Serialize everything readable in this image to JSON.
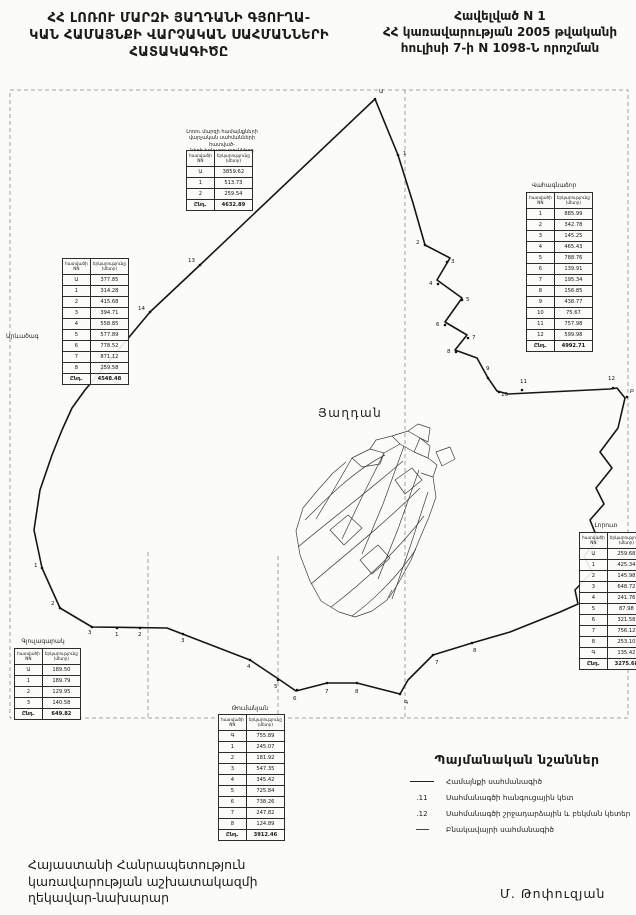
{
  "header": {
    "title_lines": [
      "ՀՀ ԼՈՌՈՒ ՄԱՐԶԻ ՅԱՂԴԱՆԻ  ԳՅՈՒՂԱ-",
      "ԿԱՆ ՀԱՄԱՅՆՔԻ ՎԱՐՉԱԿԱՆ ՍԱՀՄԱՆՆԵՐԻ",
      "ՀԱՏԱԿԱԳԻԾԸ"
    ],
    "annex_lines": [
      "Հավելված N 1",
      "ՀՀ կառավարության 2005 թվականի",
      "հուլիսի 7-ի  N 1098-Ն որոշման"
    ]
  },
  "map": {
    "community_label": "Յաղդան",
    "neighbor_label_left": "Արևածագ",
    "boundary_points": "375,99 398,155 413,203 425,245 450,258 437,280 462,298 445,322 467,335 455,350 477,358 488,378 497,391 508,394 610,389 617,388 625,398 618,428 600,452 612,468 596,488 604,504 590,520 598,540 584,556 592,572 575,590 578,604 560,612 510,632 472,643 433,655 408,680 400,694 357,683 327,683 296,691 280,680 250,660 167,628 92,627 60,608 42,568 34,530 40,490 52,455 62,430 72,408 85,390 150,312 200,265 375,99",
    "parcel_paths": [
      "M352,458 L370,449 L384,453 L380,464 L362,467 Z",
      "M370,449 L376,440 L392,436 L400,444 L384,453",
      "M392,436 L408,431 L420,438 L414,452 L400,444",
      "M408,431 L418,424 L430,428 L428,442 L420,438",
      "M420,438 L430,446 L428,458 L414,452",
      "M428,458 L437,465 L433,477 L421,473",
      "M346,462 L333,473 L317,491 L303,508",
      "M303,508 L296,531 L300,555 L310,581",
      "M310,581 L321,601 L339,612 L355,617",
      "M355,617 L372,611 L387,600 L392,590",
      "M433,477 L436,497 L429,517 L420,538 L411,560 L399,582 L389,598",
      "M305,520 C330,495 355,470 385,455",
      "M298,547 C330,520 365,494 403,461",
      "M311,584 C346,554 384,524 420,488",
      "M331,607 C361,584 395,554 424,516",
      "M352,616 C375,599 399,575 416,549",
      "M352,458 L333,491 L316,519",
      "M384,453 L361,499 L342,539",
      "M404,446 L383,504 L362,554",
      "M419,470 L398,529 L378,579",
      "M428,492 L410,547 L392,599",
      "M330,530 L348,515 L362,528 L344,545 Z",
      "M360,560 L378,545 L390,558 L372,574 Z",
      "M395,480 L412,468 L422,480 L405,494 Z",
      "M436,452 L450,447 L455,459 L442,466 Z"
    ],
    "points": [
      {
        "t": "Ա",
        "x": 375,
        "y": 99,
        "dx": 4,
        "dy": -6
      },
      {
        "t": "1",
        "x": 398,
        "y": 155,
        "dx": 5,
        "dy": 0
      },
      {
        "t": "2",
        "x": 425,
        "y": 245,
        "dx": -9,
        "dy": -1
      },
      {
        "t": "3",
        "x": 447,
        "y": 262,
        "dx": 4,
        "dy": 1
      },
      {
        "t": "4",
        "x": 438,
        "y": 284,
        "dx": -9,
        "dy": 1
      },
      {
        "t": "5",
        "x": 462,
        "y": 300,
        "dx": 4,
        "dy": 1
      },
      {
        "t": "6",
        "x": 445,
        "y": 325,
        "dx": -9,
        "dy": 1
      },
      {
        "t": "7",
        "x": 468,
        "y": 338,
        "dx": 4,
        "dy": 1
      },
      {
        "t": "8",
        "x": 456,
        "y": 352,
        "dx": -9,
        "dy": 1
      },
      {
        "t": "9",
        "x": 488,
        "y": 378,
        "dx": -2,
        "dy": -8
      },
      {
        "t": "10",
        "x": 499,
        "y": 392,
        "dx": 2,
        "dy": 4
      },
      {
        "t": "11",
        "x": 522,
        "y": 390,
        "dx": -2,
        "dy": -7
      },
      {
        "t": "12",
        "x": 613,
        "y": 388,
        "dx": -5,
        "dy": -8
      },
      {
        "t": "Բ",
        "x": 627,
        "y": 397,
        "dx": 3,
        "dy": -4
      },
      {
        "t": "13",
        "x": 200,
        "y": 265,
        "dx": -12,
        "dy": -3
      },
      {
        "t": "14",
        "x": 150,
        "y": 312,
        "dx": -12,
        "dy": -2
      },
      {
        "t": "1",
        "x": 42,
        "y": 568,
        "dx": -8,
        "dy": -1
      },
      {
        "t": "2",
        "x": 60,
        "y": 608,
        "dx": -9,
        "dy": -3
      },
      {
        "t": "3",
        "x": 92,
        "y": 627,
        "dx": -4,
        "dy": 7
      },
      {
        "t": "1",
        "x": 117,
        "y": 628,
        "dx": -2,
        "dy": 8
      },
      {
        "t": "2",
        "x": 140,
        "y": 628,
        "dx": -2,
        "dy": 8
      },
      {
        "t": "3",
        "x": 183,
        "y": 634,
        "dx": -2,
        "dy": 8
      },
      {
        "t": "4",
        "x": 250,
        "y": 660,
        "dx": -3,
        "dy": 8
      },
      {
        "t": "5",
        "x": 278,
        "y": 680,
        "dx": -4,
        "dy": 8
      },
      {
        "t": "6",
        "x": 297,
        "y": 690,
        "dx": -4,
        "dy": 10
      },
      {
        "t": "7",
        "x": 327,
        "y": 683,
        "dx": -2,
        "dy": 10
      },
      {
        "t": "8",
        "x": 357,
        "y": 683,
        "dx": -2,
        "dy": 10
      },
      {
        "t": "Գ",
        "x": 400,
        "y": 694,
        "dx": 4,
        "dy": 10
      },
      {
        "t": "7",
        "x": 433,
        "y": 655,
        "dx": 2,
        "dy": 9
      },
      {
        "t": "8",
        "x": 472,
        "y": 643,
        "dx": 1,
        "dy": 9
      }
    ]
  },
  "tables_common": {
    "col_point": "հատվածի NN",
    "col_length": "երկարությունը (մետր)",
    "total_label": "Ընդ."
  },
  "tables": {
    "north": {
      "caption_lines": [
        "Լոռու մարզի համայնքների",
        "վարչական սահմանների հատված-",
        "ների երկարությունները"
      ],
      "points": [
        "Ա",
        "1",
        "2"
      ],
      "lengths": [
        "3859.62",
        "513.73",
        "259.54"
      ],
      "total": "4632.89"
    },
    "west": {
      "points": [
        "Ա",
        "1",
        "2",
        "3",
        "4",
        "5",
        "6",
        "7",
        "8"
      ],
      "lengths": [
        "377.85",
        "314.28",
        "415.68",
        "394.71",
        "558.85",
        "577.89",
        "778.52",
        "871.12",
        "259.58"
      ],
      "total": "4548.48"
    },
    "east_upper": {
      "caption": "Վահագնաձոր",
      "points": [
        "1",
        "2",
        "3",
        "4",
        "5",
        "6",
        "7",
        "8",
        "9",
        "10",
        "11",
        "12"
      ],
      "lengths": [
        "885.99",
        "342.78",
        "145.25",
        "465.43",
        "788.76",
        "139.91",
        "195.34",
        "156.85",
        "438.77",
        "75.67",
        "757.98",
        "599.98"
      ],
      "total": "4992.71"
    },
    "east_lower": {
      "caption": "Լորուտ",
      "points": [
        "Ա",
        "1",
        "2",
        "3",
        "4",
        "5",
        "6",
        "7",
        "8",
        "Գ"
      ],
      "lengths": [
        "259.68",
        "425.34",
        "145.98",
        "648.72",
        "241.76",
        "87.98",
        "321.58",
        "756.12",
        "253.10",
        "135.42"
      ],
      "total": "3275.68"
    },
    "south_west": {
      "caption": "Գյուլագարակ",
      "points": [
        "Ա",
        "1",
        "2",
        "3"
      ],
      "lengths": [
        "189.50",
        "189.79",
        "129.95",
        "140.58"
      ],
      "total": "649.82"
    },
    "south": {
      "caption": "Թումանյան",
      "points": [
        "Գ",
        "1",
        "2",
        "3",
        "4",
        "5",
        "6",
        "7",
        "8"
      ],
      "lengths": [
        "755.89",
        "245.07",
        "181.92",
        "547.35",
        "345.42",
        "725.84",
        "738.26",
        "247.82",
        "124.89"
      ],
      "total": "3912.46"
    }
  },
  "legend": {
    "title": "Պայմանական նշաններ",
    "items": [
      {
        "symbol_type": "solid-line",
        "symbol_text": "",
        "label": "Համայնքի սահմանագիծ"
      },
      {
        "symbol_type": "node-point",
        "symbol_text": ".11",
        "label": "Սահմանագծի հանգուցային կետ"
      },
      {
        "symbol_type": "break-point",
        "symbol_text": ".12",
        "label": "Սահմանագծի շրջադարձային և բեկման կետեր"
      },
      {
        "symbol_type": "settlement-line",
        "symbol_text": "",
        "label": "Բնակավայրի սահմանագիծ"
      }
    ]
  },
  "footer": {
    "left_lines": [
      "Հայաստանի Հանրապետություն",
      "կառավարության աշխատակազմի",
      "ղեկավար-նախարար"
    ],
    "signature": "Մ. Թոփուզյան"
  }
}
